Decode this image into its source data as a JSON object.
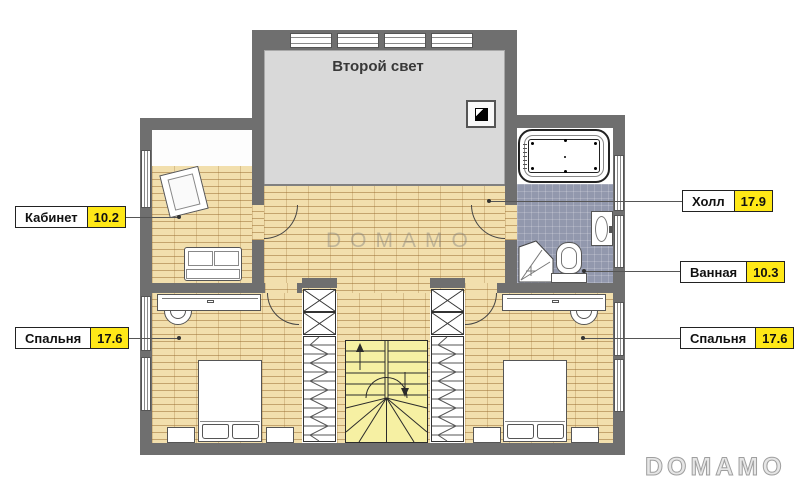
{
  "plan": {
    "second_light_label": "Второй свет",
    "callouts": [
      {
        "id": "office",
        "name": "Кабинет",
        "area": "10.2"
      },
      {
        "id": "hall",
        "name": "Холл",
        "area": "17.9"
      },
      {
        "id": "bathroom",
        "name": "Ванная",
        "area": "10.3"
      },
      {
        "id": "bedroom-left",
        "name": "Спальня",
        "area": "17.6"
      },
      {
        "id": "bedroom-right",
        "name": "Спальня",
        "area": "17.6"
      }
    ],
    "watermark_center": "DOMAMO",
    "watermark_corner": "DOMAMO",
    "colors": {
      "wall": "#6f6f6f",
      "parquet": "#f2dfad",
      "parquet_line": "#c9a05f",
      "tile": "#9298ad",
      "stairs": "#f6f0a3",
      "area_badge": "#ffe817",
      "second_light_floor": "#d9d9d9"
    }
  }
}
